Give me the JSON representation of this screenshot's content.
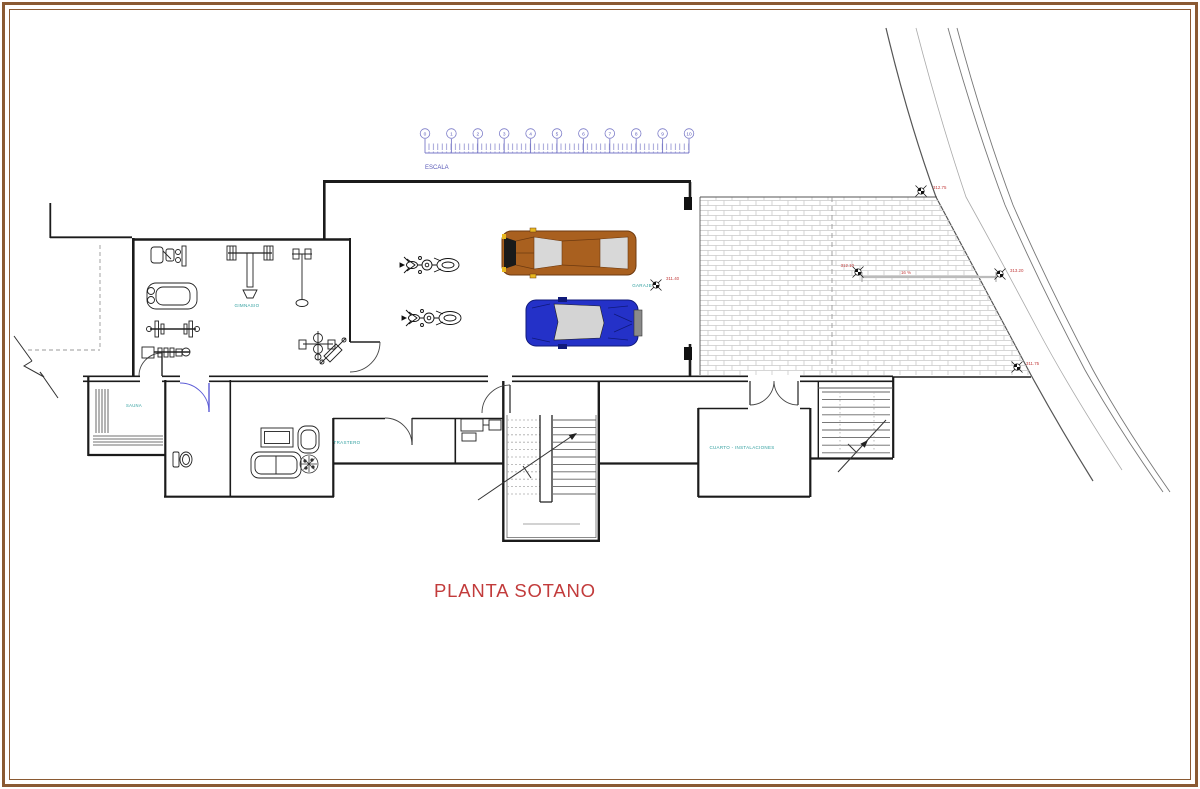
{
  "title": {
    "label": "PLANTA SOTANO"
  },
  "scale_bar": {
    "label": "ESCALA",
    "numbers": [
      "0",
      "1",
      "2",
      "3",
      "4",
      "5",
      "6",
      "7",
      "8",
      "9",
      "10"
    ]
  },
  "room_labels": {
    "gimnasio": "GIMNASIO",
    "garaje": "GARAJE",
    "sauna": "SAUNA",
    "trastero": "TRASTERO",
    "cuarto_instalaciones": "CUARTO - INSTALACIONES"
  },
  "level_markers": [
    {
      "value": "312.75"
    },
    {
      "value": "312.10"
    },
    {
      "value": "313.20"
    },
    {
      "value": "311.75"
    },
    {
      "value": "311.40"
    }
  ],
  "ramp": {
    "slope_label": "16 %"
  },
  "colors": {
    "wall": "#1b1b1b",
    "label_teal": "#2f9e9e",
    "dimension_red": "#c23b3b",
    "scale_blue": "#7878c8",
    "hatch_gray": "#c9c9c9",
    "door_blue": "#5b5bd6",
    "car_brown": "#a9601f",
    "car_blue": "#2431c8",
    "frame_brown": "#8a5a33"
  }
}
